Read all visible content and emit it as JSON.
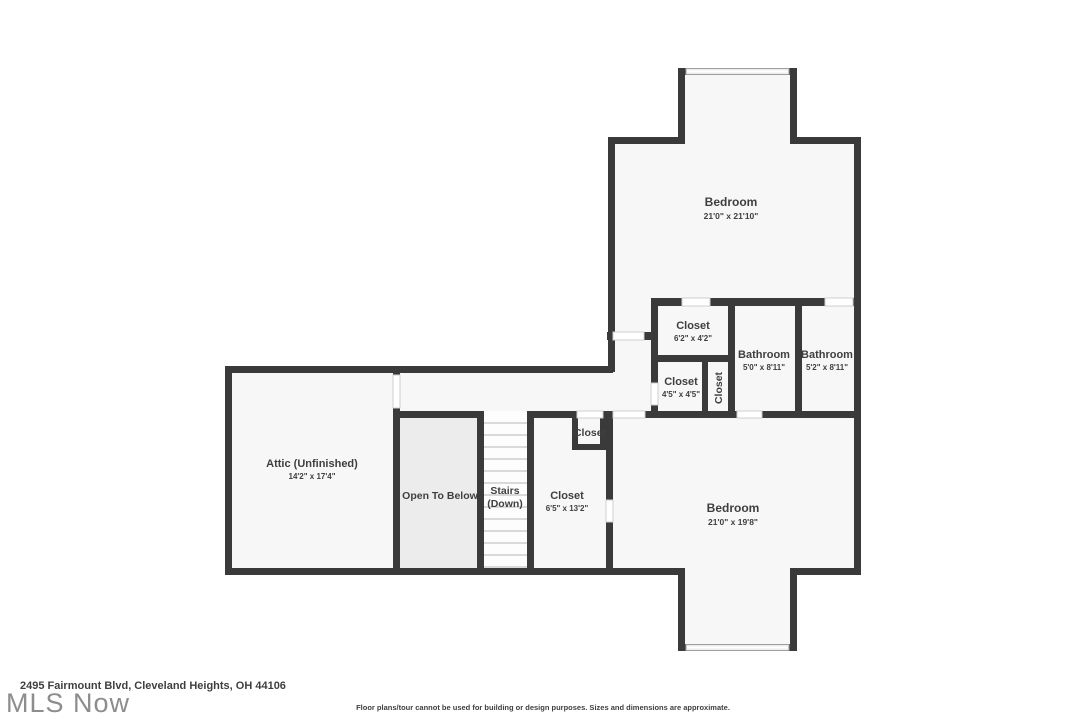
{
  "footer": {
    "address": "2495 Fairmount Blvd, Cleveland Heights, OH 44106",
    "logo": "MLS Now",
    "disclaimer": "Floor plans/tour cannot be used for building or design purposes. Sizes and dimensions are approximate."
  },
  "colors": {
    "wall": "#3a3a3a",
    "room_fill": "#f7f7f7",
    "open_to_below_fill": "#ececec",
    "stair_tread": "#d9d9d9",
    "door_line": "#cfcfcf",
    "window_line": "#9e9e9e",
    "label_text": "#3f3f3f",
    "logo_gray": "#8d8d8d"
  },
  "rooms": {
    "bedroom_upper": {
      "name": "Bedroom",
      "dims": "21'0\" x 21'10\""
    },
    "closet_top": {
      "name": "Closet",
      "dims": "6'2\" x 4'2\""
    },
    "bathroom_left": {
      "name": "Bathroom",
      "dims": "5'0\" x 8'11\""
    },
    "bathroom_right": {
      "name": "Bathroom",
      "dims": "5'2\" x 8'11\""
    },
    "closet_mid": {
      "name": "Closet",
      "dims": "4'5\" x 4'5\""
    },
    "closet_vertical": {
      "name": "Closet"
    },
    "attic": {
      "name": "Attic (Unfinished)",
      "dims": "14'2\" x 17'4\""
    },
    "open_to_below": {
      "name": "Open To Below"
    },
    "stairs": {
      "name": "Stairs",
      "sub": "(Down)"
    },
    "closet_long": {
      "name": "Closet",
      "dims": "6'5\" x 13'2\""
    },
    "closet_small": {
      "name": "Closet"
    },
    "bedroom_lower": {
      "name": "Bedroom",
      "dims": "21'0\" x 19'8\""
    }
  }
}
